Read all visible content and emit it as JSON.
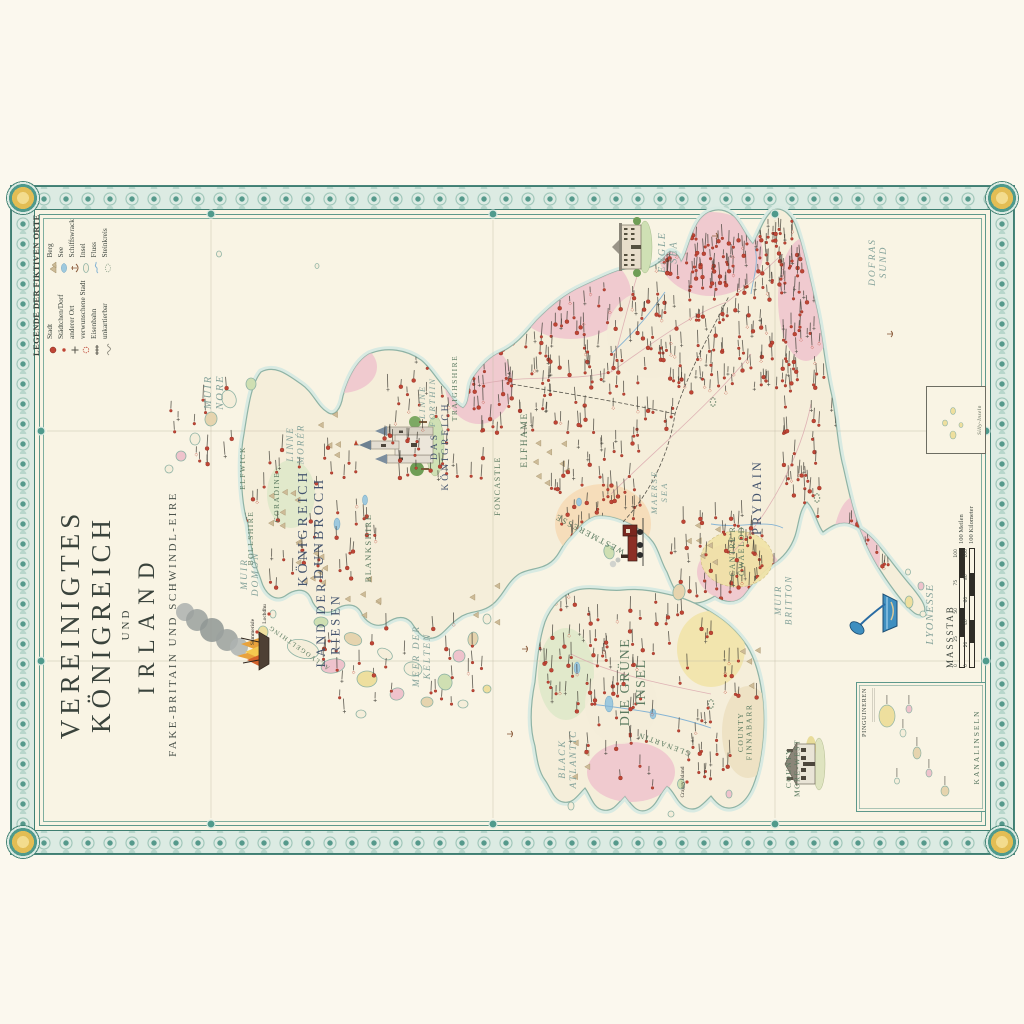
{
  "title": {
    "line1": "VEREINIGTES KÖNIGREICH",
    "line2": "UND",
    "line3": "IRLAND",
    "subtitle": "FAKE-BRITAIN UND SCHWINDL-EIRE"
  },
  "legend": {
    "title": "LEGENDE DER FIKTIVEN ORTE",
    "items_left": [
      {
        "icon": "city-dot-icon",
        "label": "Stadt"
      },
      {
        "icon": "village-dot-icon",
        "label": "Städtchen/Dorf"
      },
      {
        "icon": "other-place-icon",
        "label": "anderer Ort"
      },
      {
        "icon": "cursed-town-icon",
        "label": "verwunschene Stadt"
      },
      {
        "icon": "railway-icon",
        "label": "Eisenbahn"
      },
      {
        "icon": "unmappable-icon",
        "label": "unkartierbar"
      }
    ],
    "items_right": [
      {
        "icon": "mountain-icon",
        "label": "Berg"
      },
      {
        "icon": "lake-icon",
        "label": "See"
      },
      {
        "icon": "shipwreck-icon",
        "label": "Schiffswrack"
      },
      {
        "icon": "island-icon",
        "label": "Insel"
      },
      {
        "icon": "river-icon",
        "label": "Fluss"
      },
      {
        "icon": "stone-circle-icon",
        "label": "Steinkreis"
      }
    ]
  },
  "scale": {
    "title": "MASSSTAB",
    "miles_label": "100 Meilen",
    "km_label": "100 Kilometer",
    "miles_ticks": [
      "0",
      "25",
      "50",
      "75",
      "100"
    ],
    "km_ticks": [
      "0",
      "20",
      "40",
      "60",
      "80",
      "100"
    ]
  },
  "insets": {
    "channel": {
      "title": "PINGUINEREN",
      "caption": "KANALINSELN"
    },
    "silly": {
      "caption": "Silly-Inseln"
    }
  },
  "labels": {
    "seas": [
      {
        "text": "MUIR\nNORE",
        "x": 462,
        "y": 200,
        "s": 10.5
      },
      {
        "text": "LINNE\nMORÉR",
        "x": 410,
        "y": 282,
        "s": 9
      },
      {
        "text": "LINNE\nFORTHIN",
        "x": 452,
        "y": 414,
        "s": 8.5
      },
      {
        "text": "MUIR\nDOMON",
        "x": 280,
        "y": 236,
        "s": 9.5
      },
      {
        "text": "MEER DER\nKELTEN",
        "x": 198,
        "y": 408,
        "s": 9.5
      },
      {
        "text": "MAERSE\nSEA",
        "x": 362,
        "y": 646,
        "s": 8.5
      },
      {
        "text": "ENGLE\nSEA",
        "x": 602,
        "y": 654,
        "s": 10
      },
      {
        "text": "DOFRAS\nSUND",
        "x": 592,
        "y": 864,
        "s": 9.5
      },
      {
        "text": "BLACK\nATLANTIC",
        "x": 95,
        "y": 554,
        "s": 9.5
      },
      {
        "text": "MUIR\nBRITTON",
        "x": 254,
        "y": 770,
        "s": 9
      }
    ],
    "regions": [
      {
        "text": "KÖNIGREICH\nDUNBROCH",
        "x": 326,
        "y": 296,
        "s": 14,
        "c": "navy"
      },
      {
        "text": "LAND DER\nRIESEN",
        "x": 230,
        "y": 314,
        "s": 12.5,
        "c": "navy"
      },
      {
        "text": "DAS\nKÖNIGREICH",
        "x": 408,
        "y": 426,
        "s": 9.5,
        "c": "navy"
      },
      {
        "text": "DIE GRÜNE\nINSEL",
        "x": 172,
        "y": 618,
        "s": 14,
        "c": "green"
      },
      {
        "text": "PRYDAIN",
        "x": 357,
        "y": 750,
        "s": 12.5,
        "c": "navy"
      },
      {
        "text": "CANTRE'R\nGWAELOD",
        "x": 303,
        "y": 724,
        "s": 8,
        "c": "green"
      },
      {
        "text": "ELFHAME",
        "x": 414,
        "y": 516,
        "s": 9.5,
        "c": "green"
      },
      {
        "text": "FONCASTLE",
        "x": 368,
        "y": 489,
        "s": 8,
        "c": "green"
      },
      {
        "text": "WESTMERESSE",
        "x": 322,
        "y": 580,
        "s": 8.5,
        "c": "green",
        "rot": -62
      },
      {
        "text": "TRAIGHSHIRE",
        "x": 466,
        "y": 446,
        "s": 7.5,
        "c": "green"
      },
      {
        "text": "BLANKSHIRE",
        "x": 306,
        "y": 360,
        "s": 8.5,
        "c": "green"
      },
      {
        "text": "BOLLSHIRE",
        "x": 316,
        "y": 242,
        "s": 7.5,
        "c": "green"
      },
      {
        "text": "ELFWICK",
        "x": 386,
        "y": 234,
        "s": 7.5,
        "c": "green"
      },
      {
        "text": "CORADINE",
        "x": 357,
        "y": 268,
        "s": 7.5,
        "c": "green"
      },
      {
        "text": "ALLVOGELTHING",
        "x": 208,
        "y": 289,
        "s": 6.5,
        "c": "green",
        "rot": -55
      },
      {
        "text": "GLENARTIN",
        "x": 112,
        "y": 654,
        "s": 7.5,
        "c": "green",
        "rot": -70
      },
      {
        "text": "COUNTY\nFINNABARR",
        "x": 122,
        "y": 732,
        "s": 7.5,
        "c": "green"
      },
      {
        "text": "COUNTY\nMORE-WEST",
        "x": 86,
        "y": 780,
        "s": 7.5,
        "c": "green"
      },
      {
        "text": "LYONESSE",
        "x": 240,
        "y": 922,
        "s": 10.5,
        "c": "sea"
      }
    ],
    "places": [
      {
        "name": "Summerisle",
        "x": 222,
        "y": 246
      },
      {
        "name": "Lochdhu",
        "x": 240,
        "y": 258
      },
      {
        "name": "Craggy Island",
        "x": 72,
        "y": 676
      }
    ]
  },
  "map": {
    "graticule": {
      "vx": [
        193,
        423
      ],
      "hy": [
        200,
        482,
        764
      ]
    },
    "clusters": [
      {
        "cx": 540,
        "cy": 718,
        "rx": 88,
        "ry": 88,
        "n": 150,
        "clip": "gb",
        "seed": 11
      },
      {
        "cx": 480,
        "cy": 600,
        "rx": 90,
        "ry": 78,
        "n": 110,
        "clip": "gb",
        "seed": 22
      },
      {
        "cx": 485,
        "cy": 500,
        "rx": 78,
        "ry": 52,
        "n": 60,
        "clip": "gb",
        "seed": 33
      },
      {
        "cx": 450,
        "cy": 798,
        "rx": 118,
        "ry": 34,
        "n": 70,
        "clip": "gb",
        "seed": 44
      },
      {
        "cx": 600,
        "cy": 692,
        "rx": 40,
        "ry": 42,
        "n": 40,
        "clip": "gb",
        "seed": 55
      },
      {
        "cx": 300,
        "cy": 714,
        "rx": 48,
        "ry": 58,
        "n": 55,
        "clip": "gb",
        "seed": 66
      },
      {
        "cx": 352,
        "cy": 582,
        "rx": 40,
        "ry": 50,
        "n": 45,
        "clip": "gb",
        "seed": 77
      },
      {
        "cx": 292,
        "cy": 858,
        "rx": 66,
        "ry": 28,
        "n": 45,
        "clip": "gb",
        "seed": 88
      },
      {
        "cx": 432,
        "cy": 430,
        "rx": 80,
        "ry": 58,
        "n": 55,
        "clip": "gb",
        "seed": 99
      },
      {
        "cx": 335,
        "cy": 300,
        "rx": 82,
        "ry": 68,
        "n": 45,
        "clip": "gb",
        "seed": 101
      },
      {
        "cx": 190,
        "cy": 380,
        "rx": 55,
        "ry": 95,
        "n": 32,
        "clip": "",
        "seed": 112
      },
      {
        "cx": 430,
        "cy": 195,
        "rx": 45,
        "ry": 38,
        "n": 14,
        "clip": "",
        "seed": 113
      },
      {
        "cx": 158,
        "cy": 645,
        "rx": 98,
        "ry": 105,
        "n": 95,
        "clip": "ie",
        "seed": 123
      },
      {
        "cx": 200,
        "cy": 562,
        "rx": 58,
        "ry": 38,
        "n": 35,
        "clip": "ie",
        "seed": 134
      },
      {
        "cx": 598,
        "cy": 772,
        "rx": 40,
        "ry": 28,
        "n": 35,
        "clip": "gb",
        "seed": 145
      }
    ],
    "mountains": [
      {
        "x": 292,
        "y": 302,
        "n": 10
      },
      {
        "x": 342,
        "y": 272,
        "n": 7
      },
      {
        "x": 258,
        "y": 352,
        "n": 6
      },
      {
        "x": 420,
        "y": 312,
        "n": 5
      },
      {
        "x": 390,
        "y": 542,
        "n": 8
      },
      {
        "x": 312,
        "y": 692,
        "n": 7
      },
      {
        "x": 252,
        "y": 472,
        "n": 4
      },
      {
        "x": 95,
        "y": 577,
        "n": 4
      },
      {
        "x": 186,
        "y": 744,
        "n": 4
      }
    ],
    "lakes": [
      {
        "x": 330,
        "y": 326,
        "rx": 6,
        "ry": 3
      },
      {
        "x": 354,
        "y": 354,
        "rx": 5,
        "ry": 2.5
      },
      {
        "x": 150,
        "y": 598,
        "rx": 8,
        "ry": 4
      },
      {
        "x": 186,
        "y": 566,
        "rx": 6,
        "ry": 3
      },
      {
        "x": 352,
        "y": 568,
        "rx": 4,
        "ry": 2.5
      },
      {
        "x": 140,
        "y": 642,
        "rx": 5,
        "ry": 3
      }
    ],
    "islands": [
      {
        "x": 205,
        "y": 292,
        "rx": 9,
        "ry": 16,
        "rot": 15,
        "f": "base"
      },
      {
        "x": 188,
        "y": 322,
        "rx": 7,
        "ry": 12,
        "rot": -10,
        "f": "pink"
      },
      {
        "x": 215,
        "y": 342,
        "rx": 6,
        "ry": 9,
        "rot": 20,
        "f": "tan"
      },
      {
        "x": 175,
        "y": 356,
        "rx": 8,
        "ry": 10,
        "rot": 0,
        "f": "yellow"
      },
      {
        "x": 200,
        "y": 374,
        "rx": 5,
        "ry": 8,
        "rot": 30,
        "f": "base"
      },
      {
        "x": 160,
        "y": 386,
        "rx": 6,
        "ry": 7,
        "rot": -20,
        "f": "pink"
      },
      {
        "x": 185,
        "y": 402,
        "rx": 7,
        "ry": 9,
        "rot": 10,
        "f": "base"
      },
      {
        "x": 152,
        "y": 416,
        "rx": 5,
        "ry": 6,
        "rot": 0,
        "f": "tan"
      },
      {
        "x": 172,
        "y": 434,
        "rx": 8,
        "ry": 7,
        "rot": -15,
        "f": "green"
      },
      {
        "x": 198,
        "y": 448,
        "rx": 6,
        "ry": 6,
        "rot": 25,
        "f": "pink"
      },
      {
        "x": 150,
        "y": 452,
        "rx": 4,
        "ry": 5,
        "rot": 0,
        "f": "base"
      },
      {
        "x": 215,
        "y": 462,
        "rx": 7,
        "ry": 5,
        "rot": 10,
        "f": "tan"
      },
      {
        "x": 235,
        "y": 476,
        "rx": 5,
        "ry": 4,
        "rot": 0,
        "f": "base"
      },
      {
        "x": 165,
        "y": 476,
        "rx": 4,
        "ry": 4,
        "rot": 0,
        "f": "yellow"
      },
      {
        "x": 140,
        "y": 350,
        "rx": 4,
        "ry": 5,
        "rot": 0,
        "f": "base"
      },
      {
        "x": 232,
        "y": 310,
        "rx": 5,
        "ry": 7,
        "rot": 0,
        "f": "green"
      },
      {
        "x": 455,
        "y": 218,
        "rx": 9,
        "ry": 7,
        "rot": -20,
        "f": "base"
      },
      {
        "x": 435,
        "y": 200,
        "rx": 7,
        "ry": 6,
        "rot": 10,
        "f": "tan"
      },
      {
        "x": 415,
        "y": 184,
        "rx": 6,
        "ry": 5,
        "rot": 0,
        "f": "base"
      },
      {
        "x": 398,
        "y": 170,
        "rx": 5,
        "ry": 5,
        "rot": 0,
        "f": "pink"
      },
      {
        "x": 385,
        "y": 158,
        "rx": 4,
        "ry": 4,
        "rot": 0,
        "f": "base"
      },
      {
        "x": 470,
        "y": 240,
        "rx": 6,
        "ry": 5,
        "rot": 0,
        "f": "green"
      },
      {
        "x": 600,
        "y": 208,
        "rx": 3,
        "ry": 2.5,
        "rot": 0,
        "f": "base"
      },
      {
        "x": 588,
        "y": 306,
        "rx": 2.5,
        "ry": 2,
        "rot": 0,
        "f": "base"
      },
      {
        "x": 302,
        "y": 598,
        "rx": 7,
        "ry": 5,
        "rot": -15,
        "f": "green"
      },
      {
        "x": 262,
        "y": 668,
        "rx": 8,
        "ry": 6,
        "rot": 10,
        "f": "tan"
      },
      {
        "x": 252,
        "y": 898,
        "rx": 6,
        "ry": 4,
        "rot": 0,
        "f": "yellow"
      },
      {
        "x": 268,
        "y": 910,
        "rx": 4,
        "ry": 3,
        "rot": 0,
        "f": "pink"
      },
      {
        "x": 240,
        "y": 912,
        "rx": 3,
        "ry": 3,
        "rot": 0,
        "f": "base"
      },
      {
        "x": 282,
        "y": 897,
        "rx": 3,
        "ry": 2.5,
        "rot": 0,
        "f": "base"
      },
      {
        "x": 48,
        "y": 560,
        "rx": 4,
        "ry": 3,
        "rot": 0,
        "f": "base"
      },
      {
        "x": 40,
        "y": 660,
        "rx": 3,
        "ry": 3,
        "rot": 0,
        "f": "base"
      },
      {
        "x": 60,
        "y": 718,
        "rx": 4,
        "ry": 3,
        "rot": 0,
        "f": "pink"
      },
      {
        "x": 222,
        "y": 252,
        "rx": 6,
        "ry": 5,
        "rot": 0,
        "f": "yellow"
      },
      {
        "x": 240,
        "y": 262,
        "rx": 4,
        "ry": 3,
        "rot": 0,
        "f": "base"
      },
      {
        "x": 70,
        "y": 670,
        "rx": 5,
        "ry": 3.5,
        "rot": 0,
        "f": "green"
      }
    ],
    "tints_gb": [
      {
        "x": 560,
        "y": 560,
        "rx": 45,
        "ry": 60,
        "f": "pink"
      },
      {
        "x": 600,
        "y": 700,
        "rx": 42,
        "ry": 52,
        "f": "pink"
      },
      {
        "x": 555,
        "y": 795,
        "rx": 62,
        "ry": 28,
        "f": "pink"
      },
      {
        "x": 470,
        "y": 468,
        "rx": 40,
        "ry": 34,
        "f": "pink"
      },
      {
        "x": 487,
        "y": 330,
        "rx": 26,
        "ry": 36,
        "f": "pink"
      },
      {
        "x": 300,
        "y": 845,
        "rx": 58,
        "ry": 24,
        "f": "pink"
      },
      {
        "x": 282,
        "y": 728,
        "rx": 30,
        "ry": 42,
        "f": "pink"
      },
      {
        "x": 330,
        "y": 592,
        "rx": 40,
        "ry": 48,
        "f": "orange"
      },
      {
        "x": 360,
        "y": 280,
        "rx": 34,
        "ry": 24,
        "f": "green2"
      },
      {
        "x": 520,
        "y": 640,
        "rx": 44,
        "ry": 44,
        "f": "cream2"
      }
    ],
    "tints_ie": [
      {
        "x": 180,
        "y": 555,
        "rx": 46,
        "ry": 28,
        "f": "green2"
      },
      {
        "x": 82,
        "y": 620,
        "rx": 30,
        "ry": 44,
        "f": "pink"
      },
      {
        "x": 205,
        "y": 700,
        "rx": 38,
        "ry": 34,
        "f": "yellow2"
      },
      {
        "x": 122,
        "y": 737,
        "rx": 46,
        "ry": 26,
        "f": "tan2"
      },
      {
        "x": 150,
        "y": 610,
        "rx": 40,
        "ry": 36,
        "f": "cream2"
      }
    ],
    "cantre_blob": {
      "x": 295,
      "y": 726,
      "rx": 28,
      "ry": 36,
      "f": "yellow2"
    }
  },
  "colors": {
    "accent_teal": "#4f9a8c",
    "band_bg": "#dcebe3",
    "gold": "#e3bd54",
    "paper": "#f9f4e4",
    "land": "#f5eeda",
    "coast": "#8fb3a5",
    "coast_glow": "#d8eae2",
    "town_red": "#bf4535",
    "navy_label": "#44546e",
    "green_label": "#5b7a60",
    "sea_label": "#84a29a"
  }
}
